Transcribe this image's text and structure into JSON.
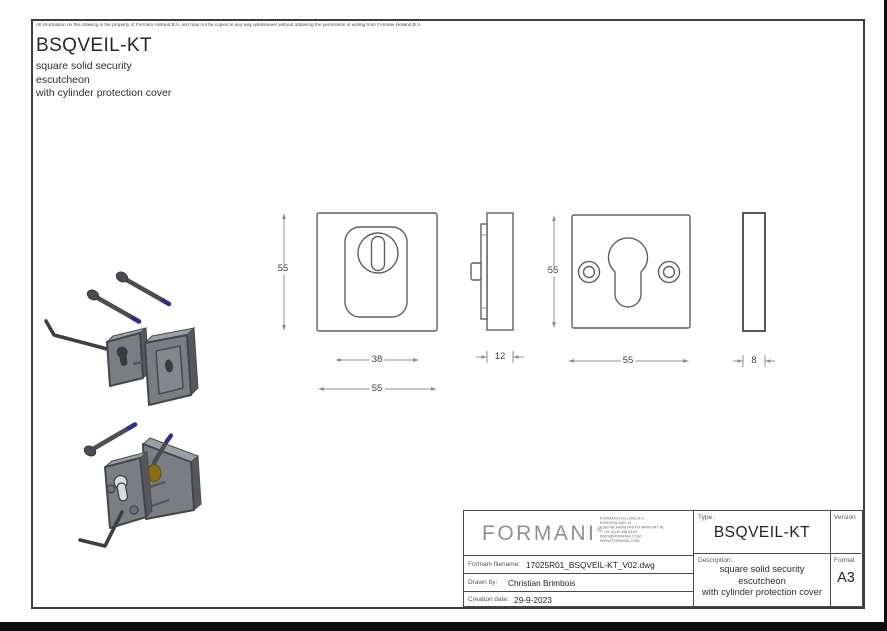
{
  "drawing": {
    "disclaimer": "All information on this drawing is the property of Formani Holland B.V. and may not be copied in any way whatsoever without obtaining the permission in writing from Formani Holland B.V.",
    "product_code": "BSQVEIL-KT",
    "subtitle_lines": [
      "square solid security",
      "escutcheon",
      "with cylinder protection cover"
    ]
  },
  "dimensions": {
    "front_cover_height": "55",
    "cover_width": "38",
    "front_cover_width": "55",
    "side_thickness": "12",
    "plate_height": "55",
    "plate_width": "55",
    "plate_thickness": "8"
  },
  "title_block": {
    "logo_text": "FORMANI",
    "logo_mark": "®",
    "address_lines": [
      "FORMANI HOLLAND B.V.",
      "EUROPALAAN 12",
      "6199 AB MAASTRICHT-AIRPORT NL",
      "T +31 (0)43 458 8119",
      "INFO@FORMANI.COM",
      "WWW.FORMANI.COM"
    ],
    "type_label": "Type :",
    "type_value": "BSQVEIL-KT",
    "version_label": "Version",
    "version_value": "",
    "filename_label": "Formani filename:",
    "filename_value": "17025R01_BSQVEIL-KT_V02.dwg",
    "drawn_by_label": "Drawn by:",
    "drawn_by_value": "Christian Brimbois",
    "creation_date_label": "Creation date:",
    "creation_date_value": "29-9-2023",
    "description_label": "Description:",
    "description_lines": [
      "square solid security",
      "escutcheon",
      "with cylinder protection cover"
    ],
    "format_label": "Format",
    "format_value": "A3"
  }
}
